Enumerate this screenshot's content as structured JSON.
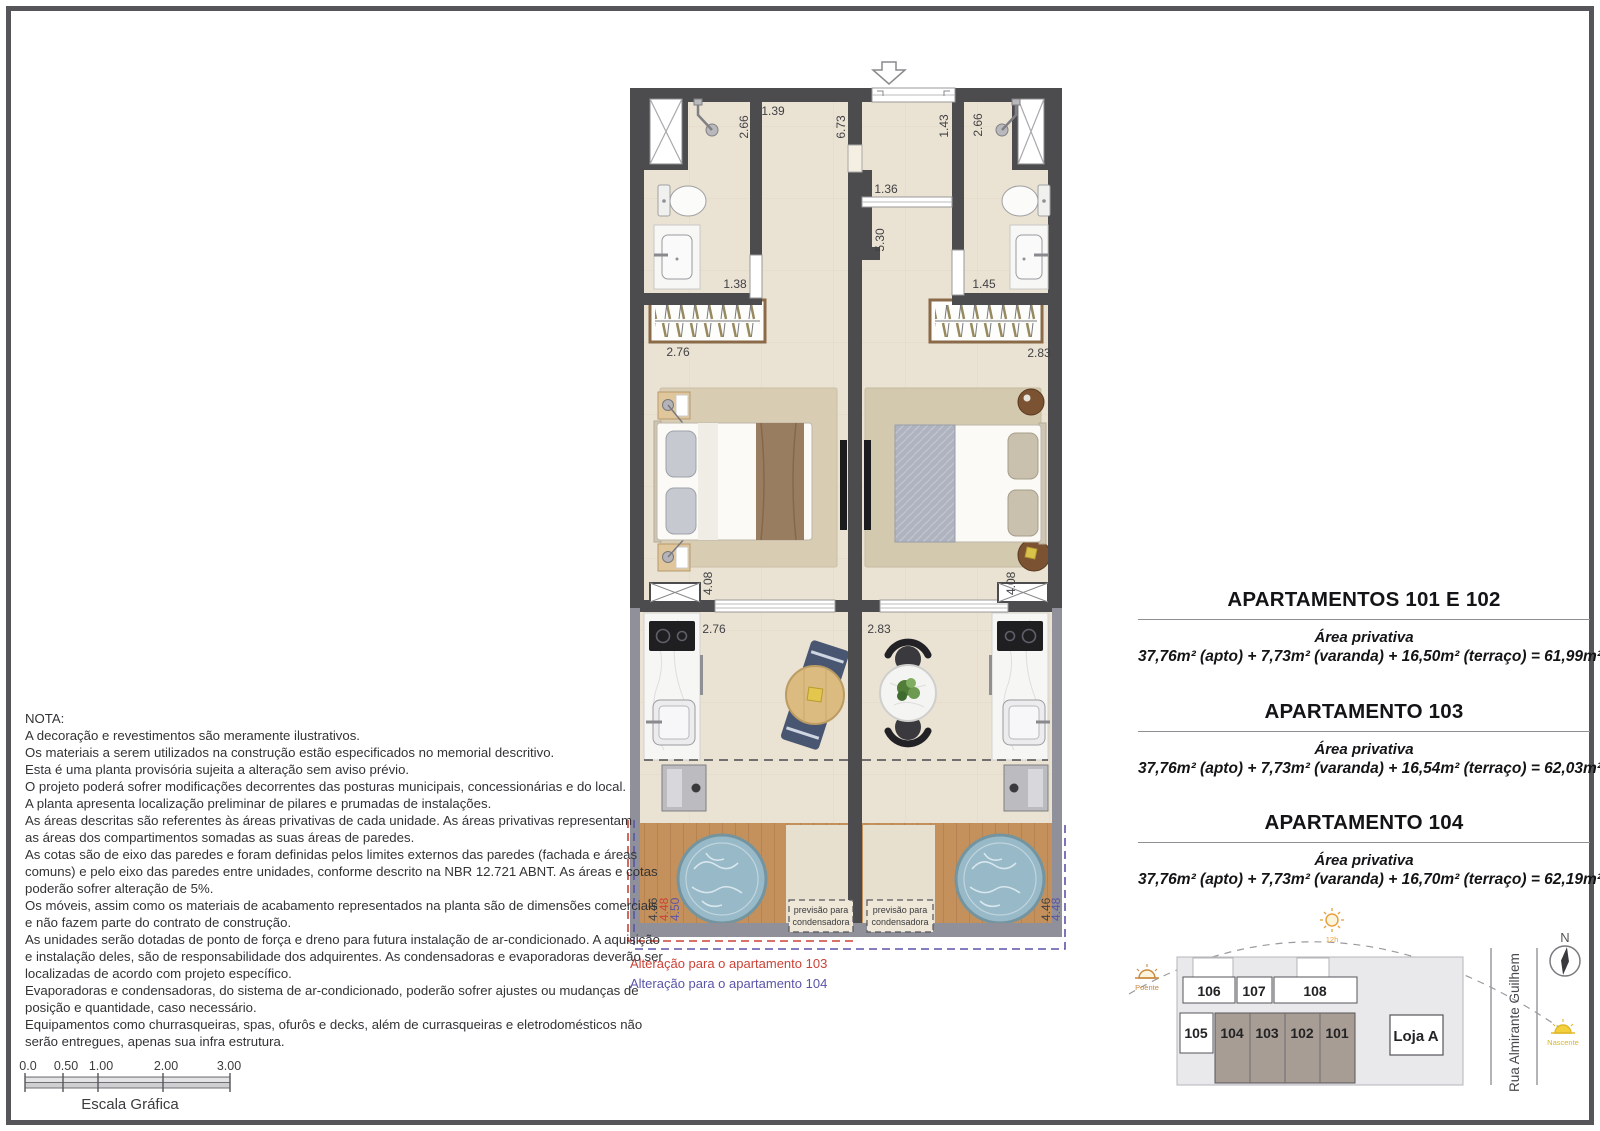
{
  "notes": {
    "title": "NOTA:",
    "lines": [
      "A decoração e revestimentos são meramente ilustrativos.",
      "Os materiais a serem utilizados na construção estão especificados no memorial descritivo.",
      "Esta é uma planta provisória sujeita a alteração sem aviso prévio.",
      "O projeto poderá sofrer modificações decorrentes das posturas municipais, concessionárias e do local.",
      "A planta apresenta localização preliminar de pilares e prumadas de instalações.",
      "As áreas descritas são referentes às áreas privativas de cada unidade. As áreas privativas representam",
      "as áreas dos compartimentos somadas as suas áreas de paredes.",
      "As cotas são de eixo das paredes e foram definidas pelos limites externos das paredes (fachada e áreas",
      "comuns) e pelo eixo das paredes entre unidades, conforme descrito na NBR 12.721 ABNT. As áreas e cotas",
      "poderão sofrer alteração de 5%.",
      "Os móveis, assim como os materiais de acabamento representados na planta são de dimensões comerciais",
      "e não fazem parte do contrato de construção.",
      "As unidades serão dotadas de ponto de força e dreno para futura instalação de ar-condicionado. A aquisição",
      "e instalação deles, são de responsabilidade dos adquirentes. As condensadoras e evaporadoras deverão ser",
      "localizadas de acordo com projeto específico.",
      "Evaporadoras e condensadoras, do sistema de ar-condicionado, poderão sofrer ajustes ou mudanças de",
      "posição e quantidade, caso necessário.",
      "Equipamentos como churrasqueiras, spas, ofurôs e decks, além de currasqueiras e eletrodomésticos não",
      "serão entregues, apenas sua infra estrutura."
    ]
  },
  "scale_bar": {
    "ticks": [
      "0.0",
      "0.50",
      "1.00",
      "2.00",
      "3.00"
    ],
    "caption": "Escala Gráfica"
  },
  "apartments": [
    {
      "title": "APARTAMENTOS 101 E 102",
      "area_label": "Área privativa",
      "formula": "37,76m² (apto) + 7,73m² (varanda) + 16,50m² (terraço) = 61,99m²"
    },
    {
      "title": "APARTAMENTO 103",
      "area_label": "Área privativa",
      "formula": "37,76m² (apto) + 7,73m² (varanda) + 16,54m² (terraço) = 62,03m²"
    },
    {
      "title": "APARTAMENTO 104",
      "area_label": "Área privativa",
      "formula": "37,76m² (apto) + 7,73m² (varanda) + 16,70m² (terraço) = 62,19m²"
    }
  ],
  "plan": {
    "dims": {
      "left_266": "2.66",
      "left_139": "1.39",
      "left_673": "6.73",
      "right_143": "1.43",
      "right_266": "2.66",
      "mid_136": "1.36",
      "mid_530": "5.30",
      "left_138": "1.38",
      "right_145": "1.45",
      "bed_left_276": "2.76",
      "bed_right_283": "2.83",
      "left_408": "4.08",
      "right_408": "4.08",
      "var_left_276": "2.76",
      "var_right_283": "2.83",
      "ter_left_446": "4.46",
      "ter_left_448": "4.48",
      "ter_left_450": "4.50",
      "ter_right_446": "4.46",
      "ter_right_448": "4.48"
    },
    "condenser_note": {
      "line1": "previsão para",
      "line2": "condensadora"
    },
    "alterations": {
      "apt103": "Alteração para o apartamento 103",
      "apt104": "Alteração para o apartamento 104"
    }
  },
  "key_plan": {
    "units_top": [
      "106",
      "107",
      "108"
    ],
    "unit_left": "105",
    "units_bottom_highlight": [
      "104",
      "103",
      "102",
      "101"
    ],
    "shop": "Loja A",
    "street": "Rua Almirante Guilhem",
    "north_label": "N",
    "sun_west": "Poente",
    "sun_noon": "12h",
    "sun_east": "Nascente"
  },
  "colors": {
    "wall": "#4c4c4e",
    "alteration_103": "#cc4236",
    "alteration_104": "#5a55a8",
    "highlighted_units": "#a89d94"
  }
}
